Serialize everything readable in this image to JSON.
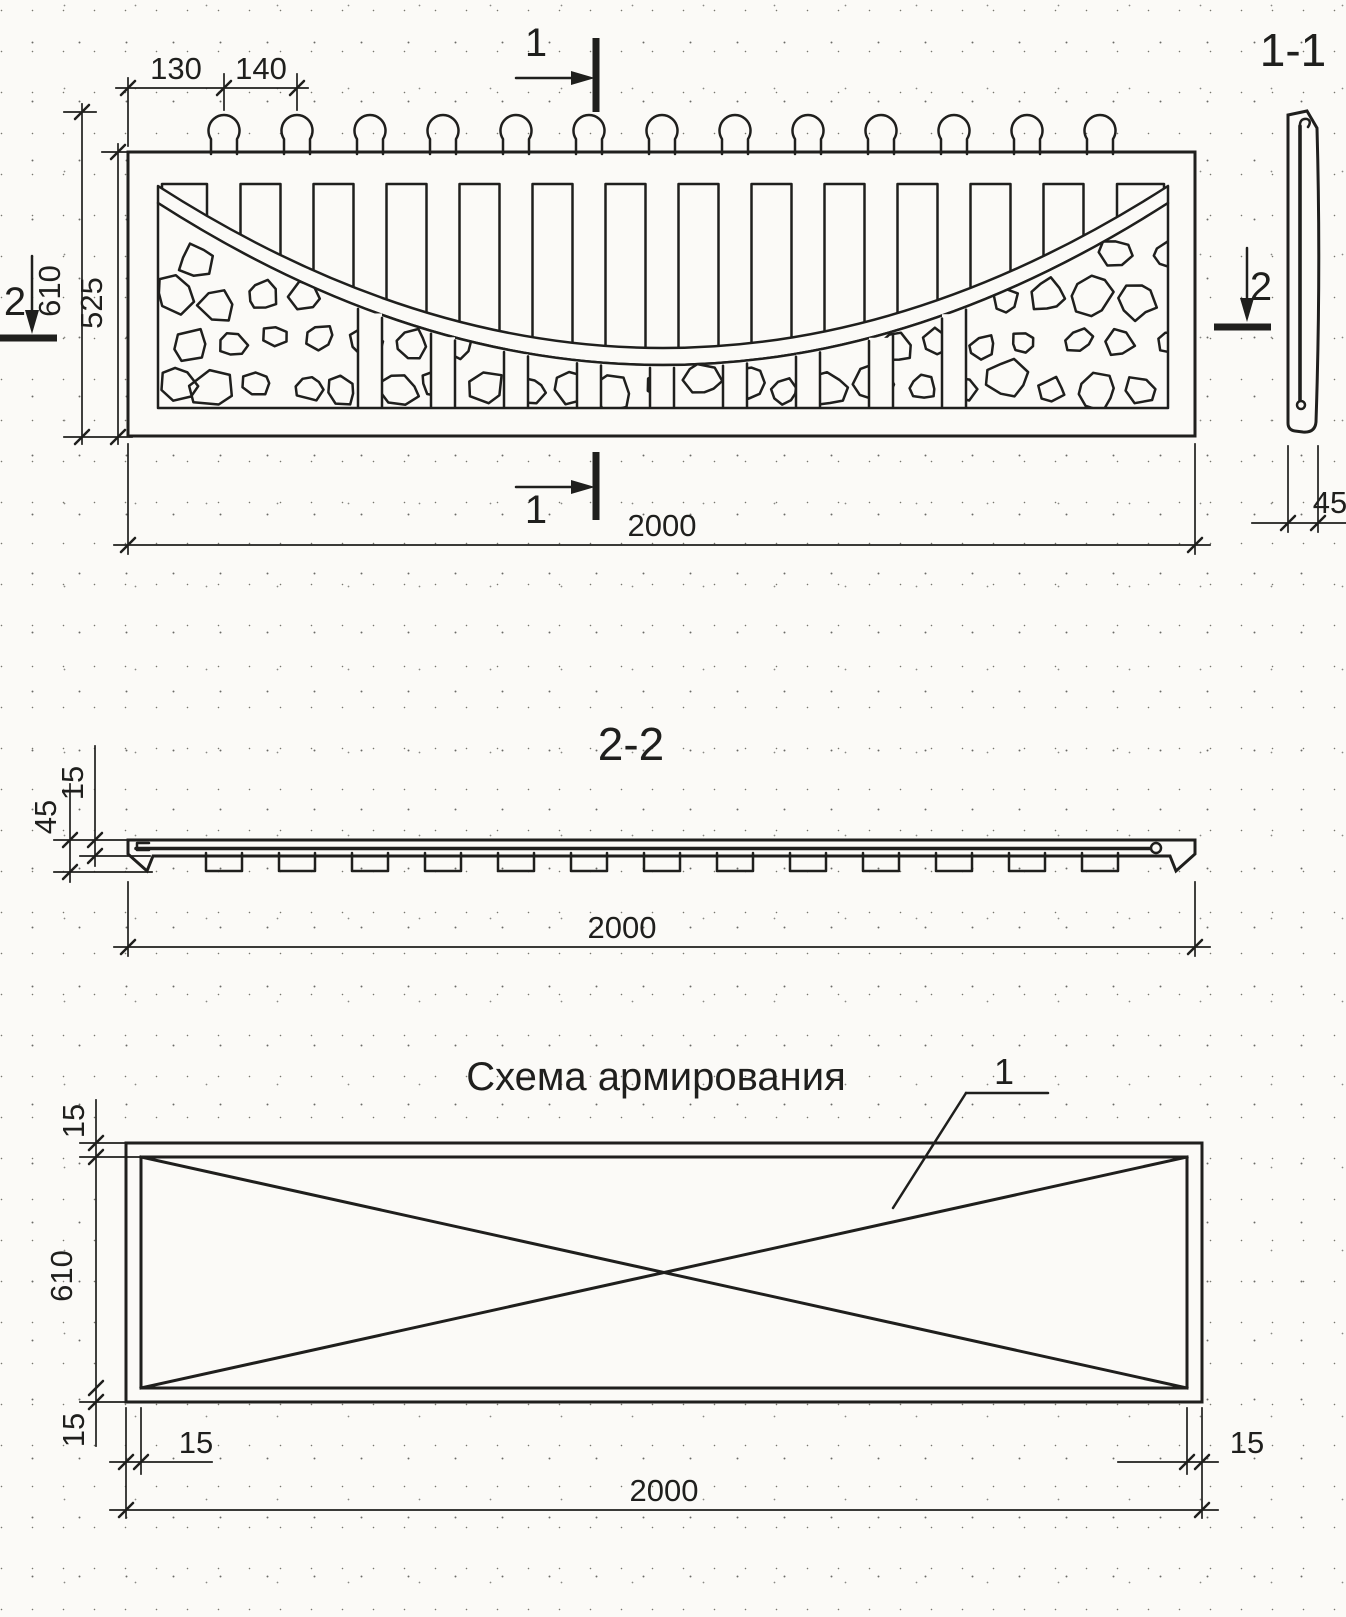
{
  "colors": {
    "ink": "#1f1f1d",
    "paper": "#fbfaf7"
  },
  "front_view": {
    "dim_margin": "130",
    "dim_pitch": "140",
    "dim_height_total": "610",
    "dim_height_field": "525",
    "dim_length": "2000",
    "section_cut_1": "1",
    "section_cut_2": "2"
  },
  "section_1_1": {
    "title": "1-1",
    "dim_thickness": "45"
  },
  "section_2_2": {
    "title": "2-2",
    "dim_web": "15",
    "dim_total": "45",
    "dim_length": "2000"
  },
  "reinforcement_scheme": {
    "title": "Схема армирования",
    "rebar_callout": "1",
    "dim_cover_top": "15",
    "dim_height": "610",
    "dim_cover_bottom": "15",
    "dim_cover_left": "15",
    "dim_cover_right": "15",
    "dim_length": "2000"
  }
}
